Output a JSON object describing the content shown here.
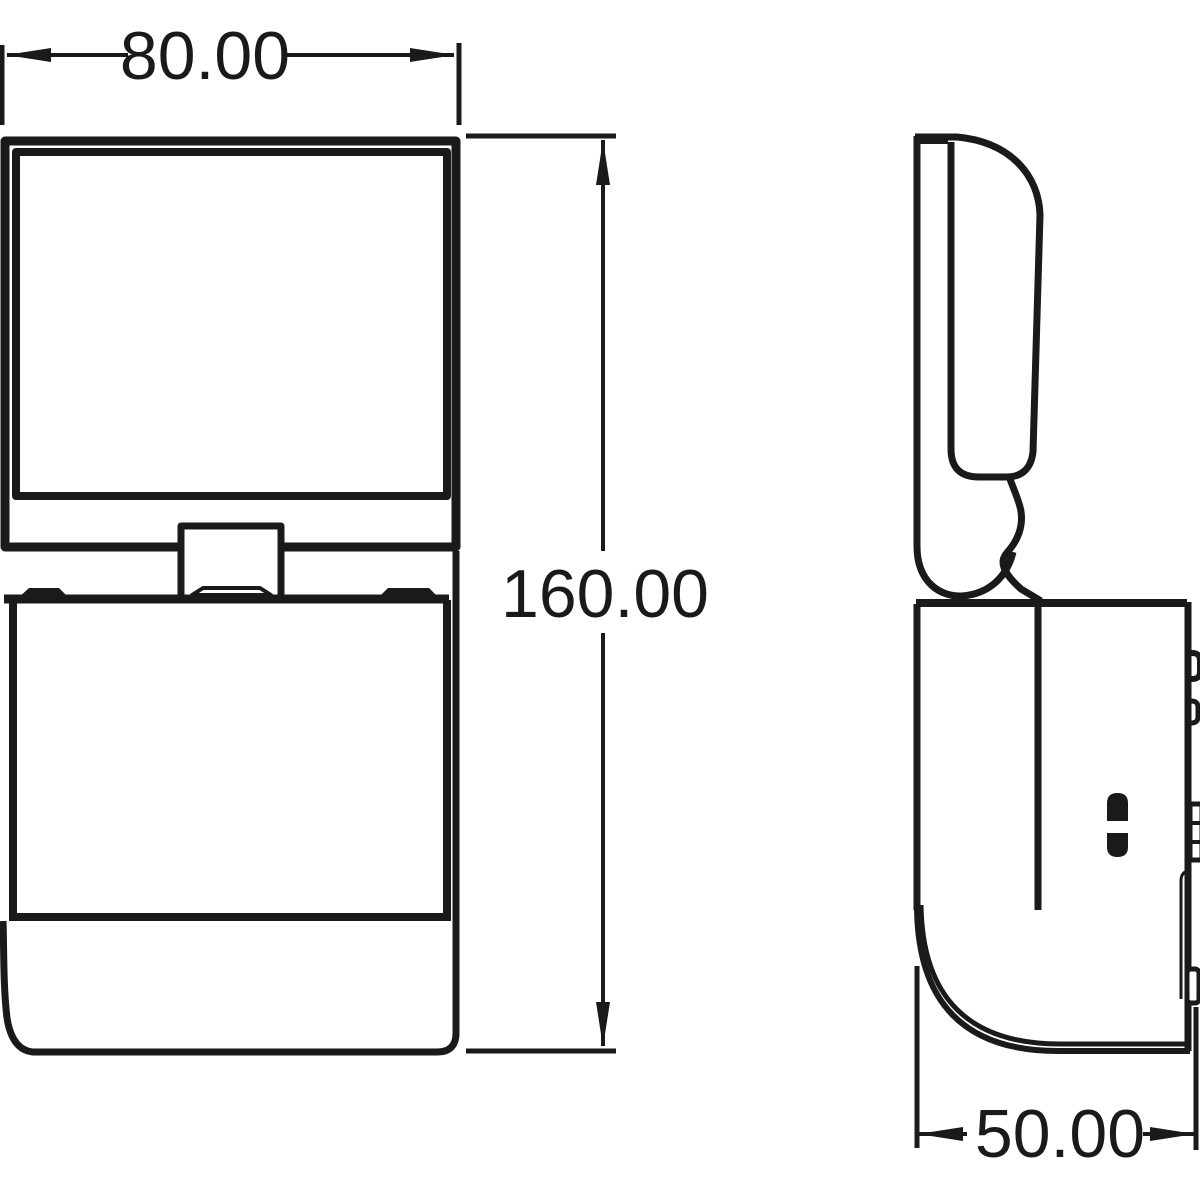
{
  "drawing": {
    "dimensions": {
      "width_label": "80.00",
      "height_label": "160.00",
      "depth_label": "50.00"
    },
    "colors": {
      "line": "#1a1a1a",
      "background": "#ffffff"
    }
  }
}
